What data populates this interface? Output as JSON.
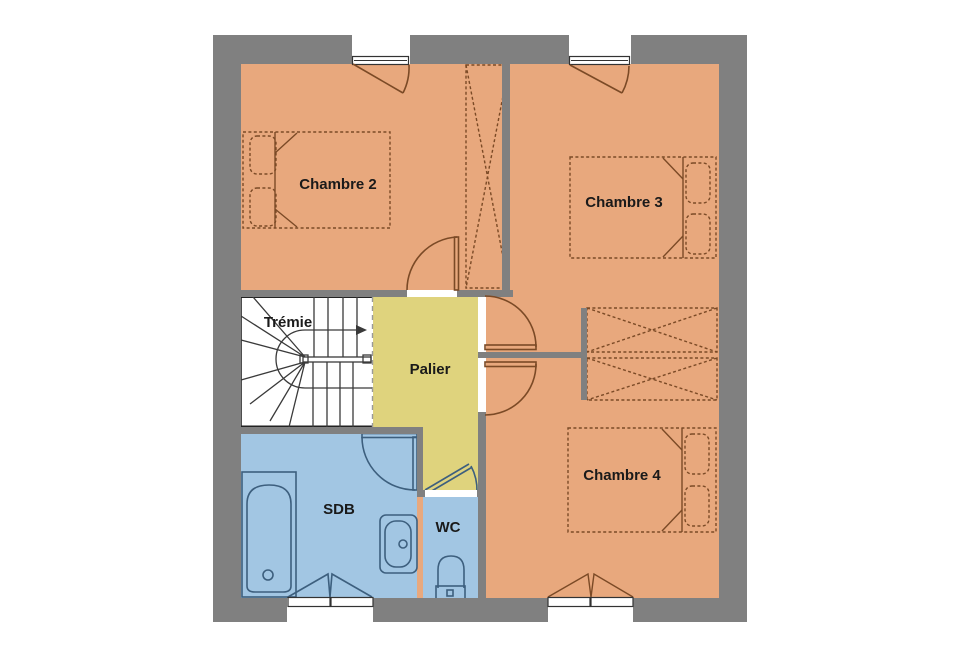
{
  "plan": {
    "type": "floor-plan",
    "floor": "étage"
  },
  "rooms": {
    "chambre2": {
      "label": "Chambre 2"
    },
    "chambre3": {
      "label": "Chambre 3"
    },
    "chambre4": {
      "label": "Chambre 4"
    },
    "tremie": {
      "label": "Trémie"
    },
    "palier": {
      "label": "Palier"
    },
    "sdb": {
      "label": "SDB"
    },
    "wc": {
      "label": "WC"
    }
  },
  "colors": {
    "wall": "#808080",
    "bedroom_fill": "#E8A87D",
    "landing_fill": "#DFD37D",
    "bath_fill": "#A2C6E3",
    "stair_fill": "#FFFFFF",
    "furniture_outline": "#7B4A26",
    "fixture_outline": "#3D5F7E",
    "stair_line": "#3A3A3A",
    "label_text": "#1A1A1A"
  }
}
